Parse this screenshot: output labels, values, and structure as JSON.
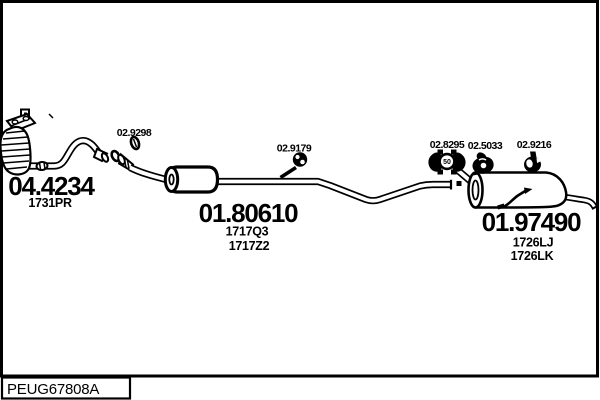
{
  "diagram": {
    "footer_code": "PEUG67808A",
    "parts": [
      {
        "name": "catalytic-converter",
        "number": "04.4234",
        "codes": [
          "1731PR"
        ]
      },
      {
        "name": "centre-muffler",
        "number": "01.80610",
        "codes": [
          "1717Q3",
          "1717Z2"
        ]
      },
      {
        "name": "rear-muffler",
        "number": "01.97490",
        "codes": [
          "1726LJ",
          "1726LK"
        ]
      }
    ],
    "fittings": [
      {
        "name": "pipe-clamp-ring",
        "number": "02.9298"
      },
      {
        "name": "rubber-hanger",
        "number": "02.9179"
      },
      {
        "name": "mounting-clamp",
        "number": "02.8295",
        "badge": "50"
      },
      {
        "name": "rubber-hook",
        "number": "02.5033"
      },
      {
        "name": "rubber-mount",
        "number": "02.9216"
      }
    ],
    "colors": {
      "line": "#000000",
      "background": "#ffffff"
    }
  }
}
